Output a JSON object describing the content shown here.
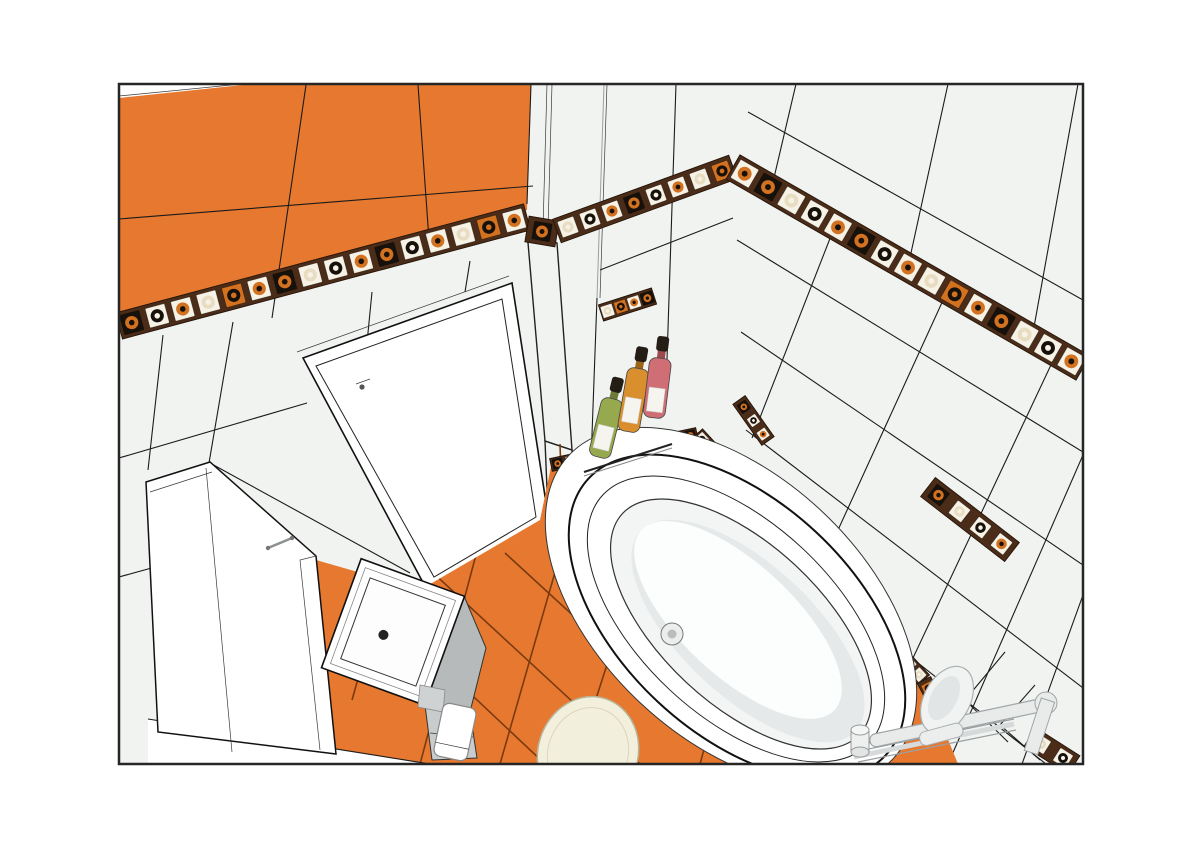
{
  "scene": {
    "kind": "3d-interior-render",
    "room": "bathroom",
    "objects": [
      "orange wall tiles",
      "decorative mosaic border strip",
      "white wall tiles",
      "entry door",
      "shower enclosure",
      "washbasin on cabinet",
      "oval bathtub",
      "toilet",
      "shampoo bottles on niche shelf",
      "wall mounted bath mixer with hand shower",
      "mosaic wall inserts",
      "orange floor tiles",
      "toilet paper holder"
    ]
  },
  "palette": {
    "page_bg": "#ffffff",
    "frame": "#262626",
    "orange": "#e6792f",
    "orange_grout": "#7a3a10",
    "wall": "#f1f3f1",
    "grout": "#1b1b1b",
    "strip_band": "#4a2c18",
    "strip_band_edge": "#241408",
    "strip_bg_light": "#f7f2e6",
    "strip_cream": "#e8ddc2",
    "strip_orange": "#d2711f",
    "strip_dark": "#17110b",
    "white": "#ffffff",
    "porcelain_shade": "#e6e9e9",
    "cabinet": "#b6babb",
    "cabinet_front": "#c9cccd",
    "toilet_cream": "#f2efdc",
    "bottle_green": "#97a94f",
    "bottle_amber": "#d98f2e",
    "bottle_pink": "#cf6f75",
    "bottle_cap": "#241d16",
    "fixture": "#e9ebeb",
    "fixture_stroke": "#9fa5a7"
  }
}
